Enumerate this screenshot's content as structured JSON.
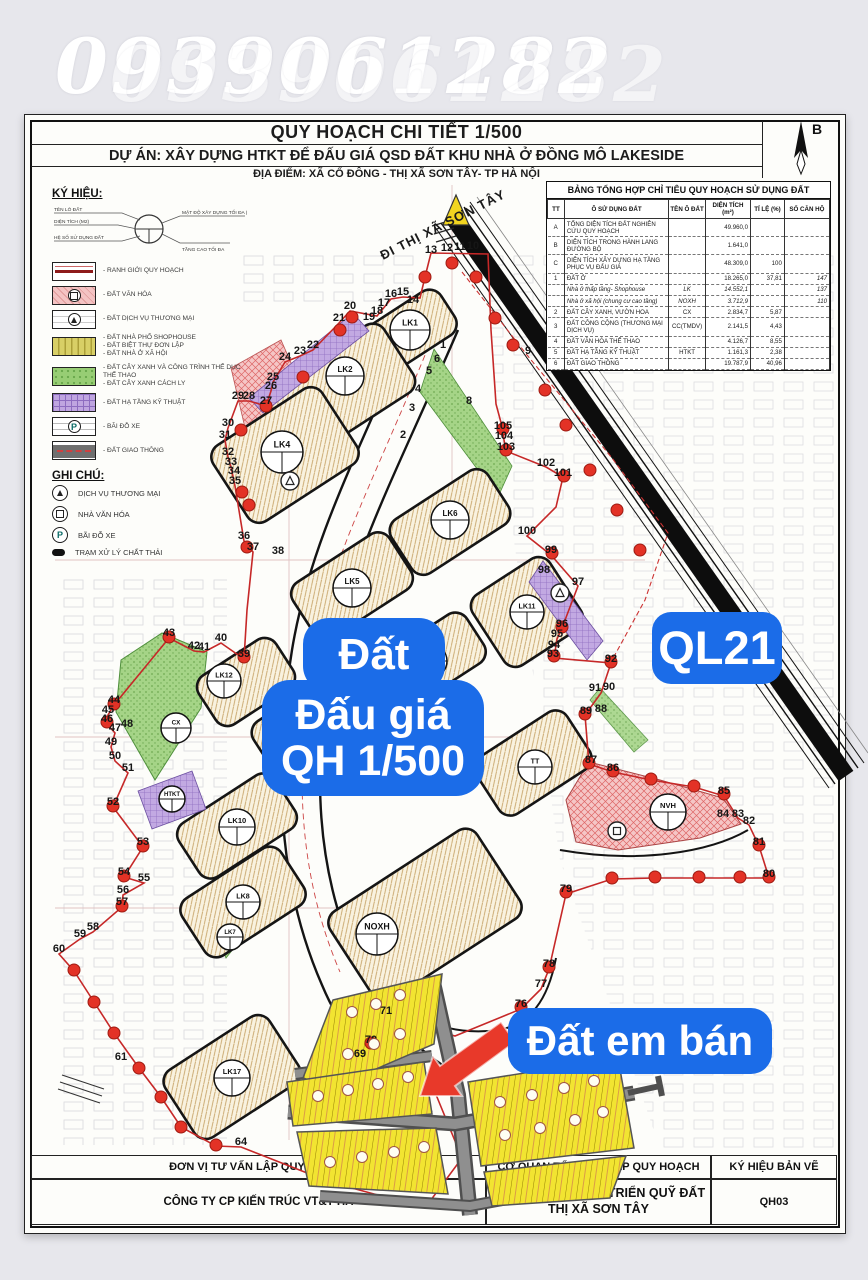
{
  "watermark": {
    "phone": "0939061282"
  },
  "title_block": {
    "title": "QUY HOẠCH CHI TIẾT 1/500",
    "project": "DỰ ÁN: XÂY DỰNG HTKT ĐỂ ĐẤU GIÁ QSD ĐẤT KHU NHÀ Ở ĐỒNG MÔ LAKESIDE",
    "location": "ĐỊA ĐIỂM: XÃ CỔ ĐÔNG - THỊ XÃ SƠN TÂY- TP HÀ NỘI",
    "compass_label": "B"
  },
  "legend": {
    "heading": "KÝ HIỆU:",
    "symbol_diagram": {
      "left_labels": [
        "TÊN LÔ ĐẤT",
        "DIỆN TÍCH (M2)",
        "HỆ SỐ SỬ DỤNG ĐẤT"
      ],
      "right_labels": [
        "MẬT ĐỘ XÂY DỰNG TỐI ĐA (%)",
        "TẦNG CAO TỐI ĐA"
      ]
    },
    "items": [
      {
        "class": "boundary",
        "glyph": "",
        "lines": [
          "RANH GIỚI QUY HOẠCH"
        ]
      },
      {
        "class": "culture",
        "glyph": "sq",
        "lines": [
          "ĐẤT VĂN HÓA"
        ]
      },
      {
        "class": "commerce",
        "glyph": "tri",
        "lines": [
          "ĐẤT DỊCH VỤ THƯƠNG MẠI"
        ]
      },
      {
        "class": "shophouse",
        "glyph": "",
        "lines": [
          "ĐẤT NHÀ PHỐ SHOPHOUSE",
          "ĐẤT BIỆT THỰ ĐƠN LẬP",
          "ĐẤT NHÀ Ở XÃ HỘI"
        ]
      },
      {
        "class": "green",
        "glyph": "",
        "lines": [
          "ĐẤT CÂY XANH VÀ CÔNG TRÌNH THỂ DỤC THỂ THAO",
          "ĐẤT CÂY XANH CÁCH LY"
        ]
      },
      {
        "class": "infra",
        "glyph": "",
        "lines": [
          "ĐẤT HẠ TẦNG KỸ THUẬT"
        ]
      },
      {
        "class": "parking",
        "glyph": "P",
        "lines": [
          "BÃI ĐỖ XE"
        ]
      },
      {
        "class": "road",
        "glyph": "",
        "lines": [
          "ĐẤT GIAO THÔNG"
        ]
      }
    ]
  },
  "notes": {
    "heading": "GHI CHÚ:",
    "items": [
      {
        "symbol": "tri",
        "glyph": "",
        "label": "DỊCH VỤ THƯƠNG MẠI"
      },
      {
        "symbol": "sq",
        "glyph": "",
        "label": "NHÀ VĂN HÓA"
      },
      {
        "symbol": "P",
        "glyph": "P",
        "label": "BÃI ĐỖ XE"
      },
      {
        "symbol": "waste",
        "glyph": "",
        "label": "TRẠM XỬ LÝ CHẤT THẢI"
      }
    ]
  },
  "summary_table": {
    "title": "BẢNG TỔNG HỢP CHỈ TIÊU QUY HOẠCH SỬ DỤNG ĐẤT",
    "columns": [
      "TT",
      "Ô SỬ DỤNG ĐẤT",
      "TÊN Ô ĐẤT",
      "DIỆN TÍCH (m²)",
      "TỈ LỆ (%)",
      "SỐ CĂN HỘ"
    ],
    "rows": [
      [
        "A",
        "TỔNG DIỆN TÍCH ĐẤT NGHIÊN CỨU QUY HOẠCH",
        "",
        "49.960,0",
        "",
        ""
      ],
      [
        "B",
        "DIỆN TÍCH TRONG HÀNH LANG ĐƯỜNG BỘ",
        "",
        "1.641,0",
        "",
        ""
      ],
      [
        "C",
        "DIỆN TÍCH XÂY DỰNG HẠ TẦNG PHỤC VỤ ĐẤU GIÁ",
        "",
        "48.309,0",
        "100",
        ""
      ],
      [
        "1",
        "ĐẤT Ở",
        "",
        "18.265,0",
        "37,81",
        "147"
      ],
      [
        "",
        "Nhà ở thấp tầng- Shophouse",
        "LK",
        "14.552,1",
        "",
        "137"
      ],
      [
        "",
        "Nhà ở xã hội (chung cư cao tầng)",
        "NOXH",
        "3.712,9",
        "",
        "110"
      ],
      [
        "2",
        "ĐẤT CÂY XANH, VƯỜN HOA",
        "CX",
        "2.834,7",
        "5,87",
        ""
      ],
      [
        "3",
        "ĐẤT CÔNG CỘNG (THƯƠNG MẠI DỊCH VỤ)",
        "CC(TMDV)",
        "2.141,5",
        "4,43",
        ""
      ],
      [
        "4",
        "ĐẤT VĂN HÓA THỂ THAO",
        "",
        "4.126,7",
        "8,55",
        ""
      ],
      [
        "5",
        "ĐẤT HẠ TẦNG KỸ THUẬT",
        "HTKT",
        "1.161,3",
        "2,38",
        ""
      ],
      [
        "6",
        "ĐẤT GIAO THÔNG",
        "",
        "19.787,9",
        "40,96",
        ""
      ]
    ]
  },
  "map": {
    "road_direction_label": "ĐI THỊ XÃ SƠN TÂY",
    "overlay_labels": {
      "auction_top": "Đất",
      "auction_line1": "Đấu giá",
      "auction_line2": "QH 1/500",
      "highway": "QL21",
      "for_sale": "Đất em bán"
    },
    "lot_circles": [
      {
        "name": "LK1",
        "x": 410,
        "y": 330,
        "r": 20
      },
      {
        "name": "LK2",
        "x": 345,
        "y": 376,
        "r": 19
      },
      {
        "name": "LK4",
        "x": 282,
        "y": 452,
        "r": 21
      },
      {
        "name": "LK6",
        "x": 450,
        "y": 520,
        "r": 19
      },
      {
        "name": "LK5",
        "x": 352,
        "y": 588,
        "r": 19
      },
      {
        "name": "LK11",
        "x": 527,
        "y": 612,
        "r": 17
      },
      {
        "name": "LK13",
        "x": 430,
        "y": 661,
        "r": 17
      },
      {
        "name": "LK12",
        "x": 224,
        "y": 681,
        "r": 17
      },
      {
        "name": "CX",
        "x": 176,
        "y": 728,
        "r": 15
      },
      {
        "name": "LK9",
        "x": 312,
        "y": 724,
        "r": 18
      },
      {
        "name": "TT",
        "x": 535,
        "y": 767,
        "r": 17
      },
      {
        "name": "HTKT",
        "x": 172,
        "y": 799,
        "r": 13
      },
      {
        "name": "LK10",
        "x": 237,
        "y": 827,
        "r": 18
      },
      {
        "name": "LK8",
        "x": 243,
        "y": 902,
        "r": 17
      },
      {
        "name": "LK7",
        "x": 230,
        "y": 937,
        "r": 13
      },
      {
        "name": "NOXH",
        "x": 377,
        "y": 934,
        "r": 21
      },
      {
        "name": "LK17",
        "x": 232,
        "y": 1078,
        "r": 18
      },
      {
        "name": "NVH",
        "x": 668,
        "y": 812,
        "r": 18
      }
    ],
    "boundary_numbers": [
      [
        "10",
        473,
        249
      ],
      [
        "11",
        460,
        250
      ],
      [
        "12",
        447,
        251
      ],
      [
        "13",
        431,
        253
      ],
      [
        "14",
        413,
        303
      ],
      [
        "15",
        403,
        295
      ],
      [
        "16",
        391,
        297
      ],
      [
        "17",
        384,
        306
      ],
      [
        "18",
        377,
        314
      ],
      [
        "19",
        369,
        320
      ],
      [
        "20",
        350,
        309
      ],
      [
        "21",
        339,
        321
      ],
      [
        "22",
        313,
        348
      ],
      [
        "23",
        300,
        354
      ],
      [
        "24",
        285,
        360
      ],
      [
        "25",
        273,
        380
      ],
      [
        "26",
        271,
        389
      ],
      [
        "27",
        266,
        404
      ],
      [
        "28",
        249,
        399
      ],
      [
        "29",
        238,
        399
      ],
      [
        "30",
        228,
        426
      ],
      [
        "31",
        225,
        438
      ],
      [
        "32",
        228,
        455
      ],
      [
        "33",
        231,
        465
      ],
      [
        "34",
        234,
        474
      ],
      [
        "35",
        235,
        484
      ],
      [
        "36",
        244,
        539
      ],
      [
        "37",
        253,
        550
      ],
      [
        "38",
        278,
        554
      ],
      [
        "39",
        244,
        657
      ],
      [
        "40",
        221,
        641
      ],
      [
        "41",
        204,
        650
      ],
      [
        "42",
        194,
        649
      ],
      [
        "43",
        169,
        636
      ],
      [
        "44",
        114,
        703
      ],
      [
        "45",
        108,
        713
      ],
      [
        "46",
        107,
        722
      ],
      [
        "47",
        115,
        731
      ],
      [
        "48",
        127,
        727
      ],
      [
        "49",
        111,
        745
      ],
      [
        "50",
        115,
        759
      ],
      [
        "51",
        128,
        771
      ],
      [
        "52",
        113,
        805
      ],
      [
        "53",
        143,
        845
      ],
      [
        "54",
        124,
        875
      ],
      [
        "55",
        144,
        881
      ],
      [
        "56",
        123,
        893
      ],
      [
        "57",
        122,
        905
      ],
      [
        "58",
        93,
        930
      ],
      [
        "59",
        80,
        937
      ],
      [
        "60",
        59,
        952
      ],
      [
        "61",
        121,
        1060
      ],
      [
        "64",
        241,
        1145
      ],
      [
        "69",
        360,
        1057
      ],
      [
        "70",
        371,
        1043
      ],
      [
        "71",
        386,
        1014
      ],
      [
        "76",
        521,
        1007
      ],
      [
        "77",
        541,
        987
      ],
      [
        "78",
        549,
        967
      ],
      [
        "79",
        566,
        892
      ],
      [
        "80",
        769,
        877
      ],
      [
        "81",
        759,
        845
      ],
      [
        "82",
        749,
        824
      ],
      [
        "83",
        738,
        817
      ],
      [
        "84",
        723,
        817
      ],
      [
        "85",
        724,
        794
      ],
      [
        "86",
        613,
        771
      ],
      [
        "87",
        591,
        763
      ],
      [
        "88",
        601,
        712
      ],
      [
        "89",
        586,
        714
      ],
      [
        "90",
        609,
        690
      ],
      [
        "91",
        595,
        691
      ],
      [
        "92",
        611,
        662
      ],
      [
        "93",
        553,
        657
      ],
      [
        "94",
        554,
        648
      ],
      [
        "95",
        557,
        637
      ],
      [
        "96",
        562,
        627
      ],
      [
        "97",
        578,
        585
      ],
      [
        "98",
        544,
        573
      ],
      [
        "99",
        551,
        553
      ],
      [
        "100",
        527,
        534
      ],
      [
        "101",
        563,
        476
      ],
      [
        "102",
        546,
        466
      ],
      [
        "103",
        506,
        450
      ],
      [
        "104",
        504,
        439
      ],
      [
        "105",
        503,
        429
      ],
      [
        "1",
        443,
        348
      ],
      [
        "2",
        403,
        438
      ],
      [
        "3",
        412,
        411
      ],
      [
        "4",
        418,
        392
      ],
      [
        "5",
        429,
        374
      ],
      [
        "6",
        437,
        362
      ],
      [
        "8",
        469,
        404
      ],
      [
        "9",
        528,
        354
      ]
    ]
  },
  "footer": {
    "consultant_header": "ĐƠN VỊ TƯ VẤN LẬP QUY HOẠCH",
    "consultant_name": "CÔNG TY CP KIẾN TRÚC VT&T HÀ",
    "agency_header": "CƠ QUAN TỔ CHỨC LẬP QUY HOẠCH",
    "agency_name": "TRUNG TÂM PHÁT TRIỂN QUỸ ĐẤT THỊ XÃ SƠN TÂY",
    "drawing_header": "KÝ HIỆU BẢN VẼ",
    "drawing_code": "QH03"
  },
  "colors": {
    "accent_blue": "#1b6ce8",
    "boundary_red": "#c62828",
    "arrow_red": "#e8392a",
    "lot_yellow": "#f2e431"
  }
}
